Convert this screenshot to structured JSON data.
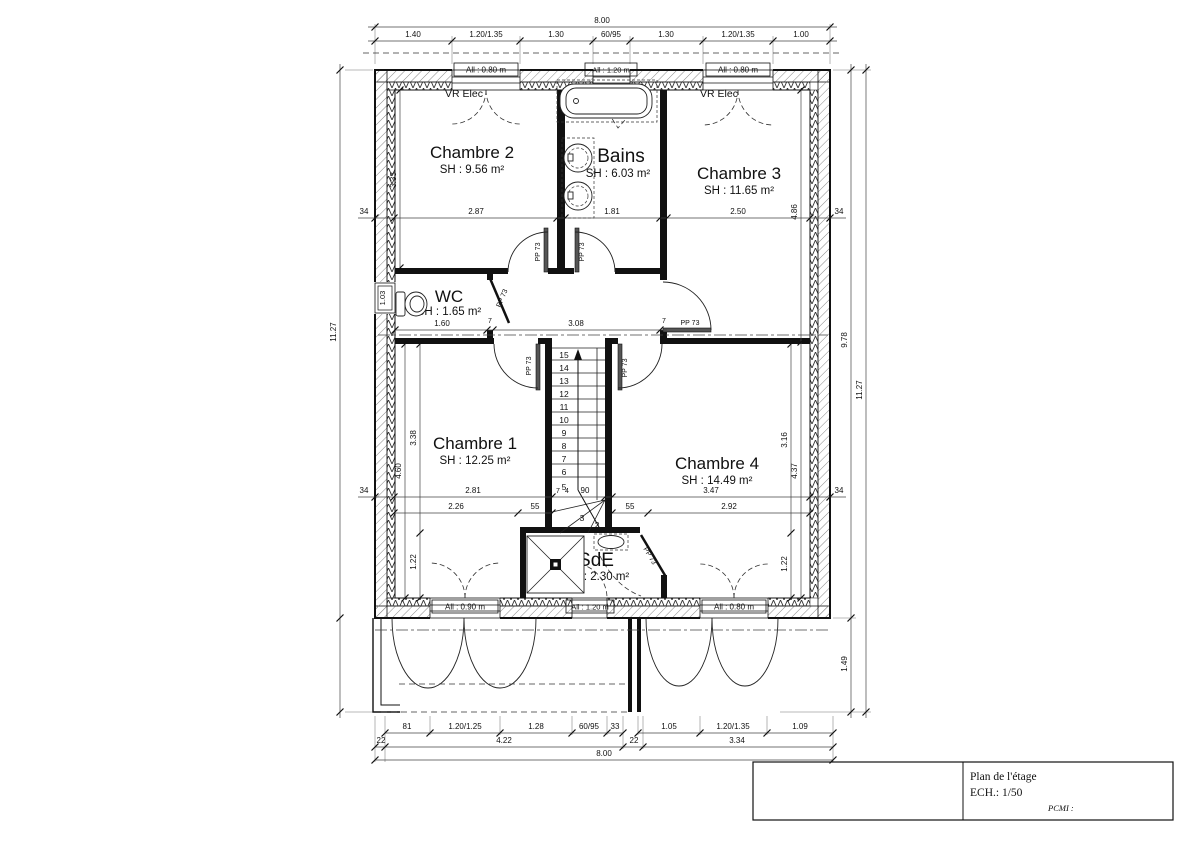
{
  "rooms": {
    "chambre2": {
      "name": "Chambre 2",
      "area": "SH : 9.56 m²"
    },
    "bains": {
      "name": "Bains",
      "area": "SH : 6.03 m²"
    },
    "chambre3": {
      "name": "Chambre 3",
      "area": "SH : 11.65 m²"
    },
    "wc": {
      "name": "WC",
      "area": "SH : 1.65 m²"
    },
    "chambre1": {
      "name": "Chambre 1",
      "area": "SH : 12.25 m²"
    },
    "chambre4": {
      "name": "Chambre 4",
      "area": "SH : 14.49 m²"
    },
    "sde": {
      "name": "SdE",
      "area": "SH : 2.30 m²"
    }
  },
  "annotations": {
    "vr_elec": "VR Elec",
    "door_label": "PP 73"
  },
  "windows": {
    "top_left": "All : 0.80 m",
    "top_center": "All : 1.20 m",
    "top_right": "All : 0.80 m",
    "left_wc": "1.03",
    "bottom_left": "All : 0.90 m",
    "bottom_center": "All : 1.20 m",
    "bottom_right": "All : 0.80 m"
  },
  "dims": {
    "top_total": "8.00",
    "top_row": [
      "1.40",
      "1.20/1.35",
      "1.30",
      "60/95",
      "1.30",
      "1.20/1.35",
      "1.00"
    ],
    "mid_row": [
      "34",
      "2.87",
      "7",
      "1.81",
      "7",
      "2.50",
      "34"
    ],
    "c3_height": "4.86",
    "c2_height": "3.33",
    "wc_width": "1.60",
    "wall_thin_a": "7",
    "hall_width": "3.08",
    "wall_thin_b": "7",
    "low_row": [
      "34",
      "2.81",
      "7",
      "4",
      "90",
      "7",
      "3.47",
      "34"
    ],
    "low_row2": [
      "2.26",
      "55",
      "55",
      "2.92"
    ],
    "c1_height": "3.38",
    "c1_lower": "1.22",
    "c1_total": "4.60",
    "c4_height": "3.16",
    "c4_lower": "1.22",
    "c4_total": "4.37",
    "left_total": "11.27",
    "right_inner": "9.78",
    "right_outer": "11.27",
    "overhang_depth": "1.49",
    "bottom_row1": [
      "81",
      "1.20/1.25",
      "1.28",
      "60/95",
      "33",
      "1.05",
      "1.20/1.35",
      "1.09"
    ],
    "bottom_row2": [
      "22",
      "4.22",
      "22",
      "3.34"
    ],
    "bottom_total": "8.00"
  },
  "stairs": {
    "steps": [
      "15",
      "14",
      "13",
      "12",
      "11",
      "10",
      "9",
      "8",
      "7",
      "6",
      "5"
    ],
    "winders": [
      "3",
      "2"
    ]
  },
  "title_block": {
    "title": "Plan de l'étage",
    "scale": "ECH.: 1/50",
    "pcmi": "PCMI :"
  }
}
